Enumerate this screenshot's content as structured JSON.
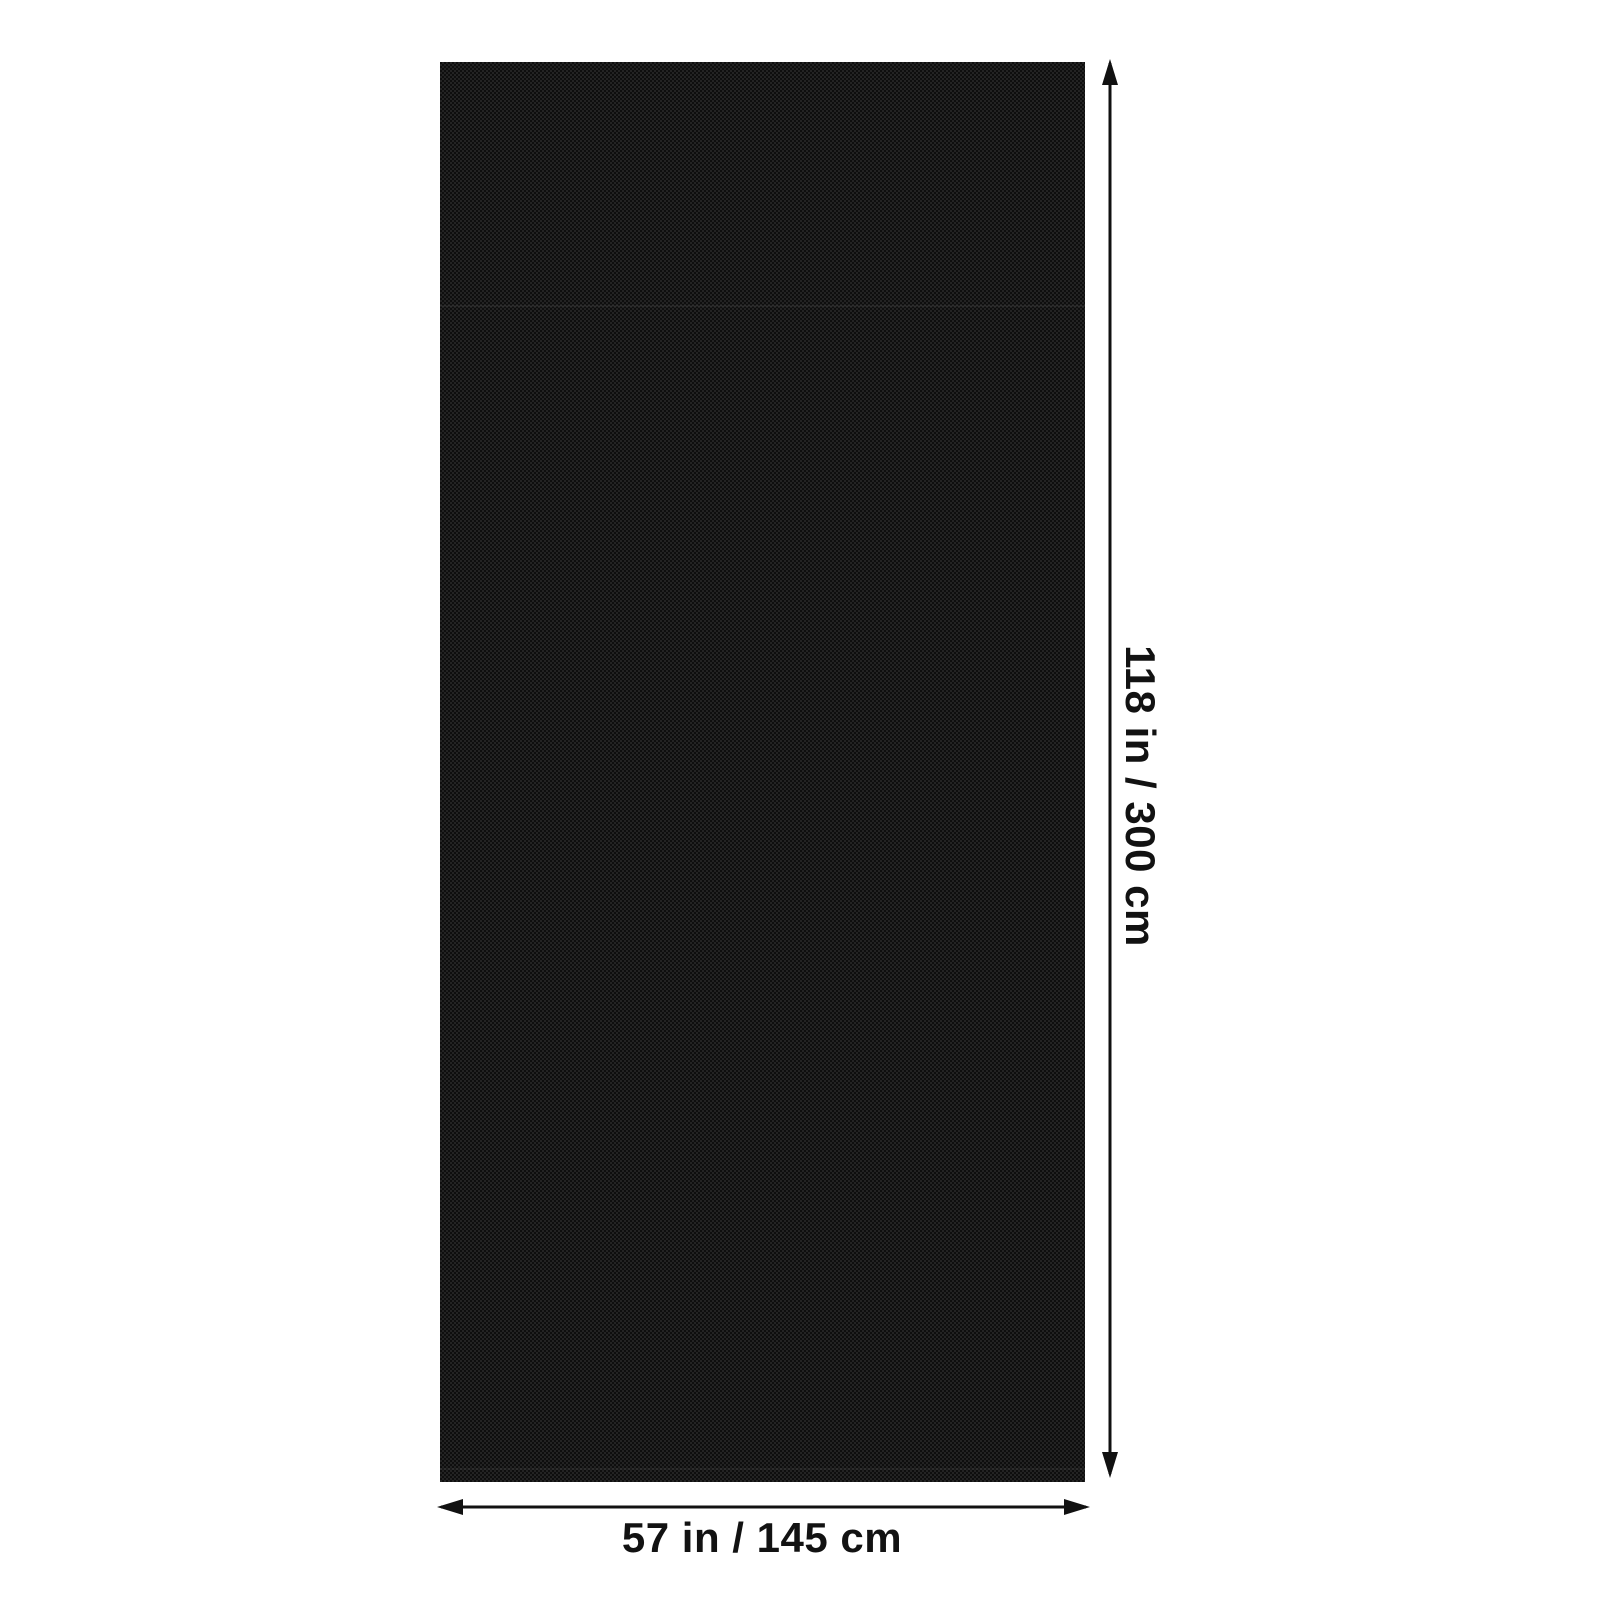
{
  "page": {
    "type": "product-dimension-diagram",
    "description": "Black fabric panel shown flat with height and width dimension arrows"
  },
  "theme": {
    "canvas_bg": "#ffffff",
    "arrow_color": "#111111",
    "text_color": "#121212",
    "fabric_base": "#181818",
    "fabric_weave_light": "#232323",
    "fabric_weave_dark": "#0e0e0e"
  },
  "product": {
    "name": "black fabric panel",
    "texture": "fine woven check"
  },
  "dimensions": {
    "height": {
      "label": "118 in / 300 cm",
      "inches": 118,
      "centimeters": 300
    },
    "width": {
      "label": "57 in / 145 cm",
      "inches": 57,
      "centimeters": 145
    }
  }
}
